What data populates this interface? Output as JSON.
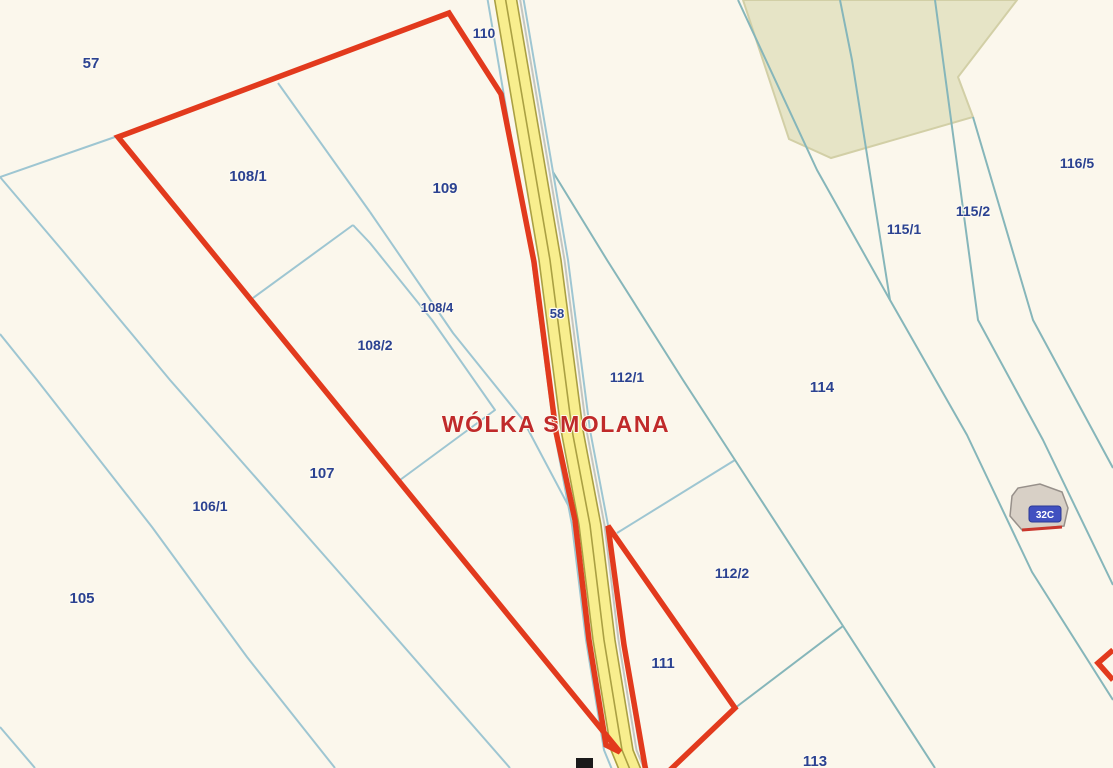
{
  "map": {
    "width": 1113,
    "height": 768,
    "background": "#fbf7ec",
    "colors": {
      "line_left": "#9ec6d2",
      "line_right": "#86b6ba",
      "selection_red": "#e23a1d",
      "label_navy": "#2b4291",
      "place_red": "#c02a2a",
      "road_yellow": "#f8ee8e",
      "road_olive": "#aaa043",
      "road_edge_blue": "#9ec6d2",
      "road_gray": "#c4c6c0",
      "green_fill": "#e6e4c6",
      "green_edge": "#d2cfa6",
      "building_fill": "#d8d0c6",
      "building_edge": "#97908a",
      "addr_bg": "#4150c0",
      "addr_text": "#ffffff",
      "marker_black": "#1a1a1a"
    },
    "place_label": {
      "text": "WÓLKA SMOLANA",
      "x": 556,
      "y": 432,
      "size": 23
    },
    "parcel_labels": [
      {
        "text": "57",
        "x": 91,
        "y": 68,
        "size": 15
      },
      {
        "text": "108/1",
        "x": 248,
        "y": 181,
        "size": 15
      },
      {
        "text": "109",
        "x": 445,
        "y": 193,
        "size": 15
      },
      {
        "text": "110",
        "x": 484,
        "y": 38,
        "size": 14
      },
      {
        "text": "108/4",
        "x": 437,
        "y": 312,
        "size": 13
      },
      {
        "text": "108/2",
        "x": 375,
        "y": 350,
        "size": 14
      },
      {
        "text": "58",
        "x": 557,
        "y": 318,
        "size": 13
      },
      {
        "text": "107",
        "x": 322,
        "y": 478,
        "size": 15
      },
      {
        "text": "106/1",
        "x": 210,
        "y": 511,
        "size": 14
      },
      {
        "text": "105",
        "x": 82,
        "y": 603,
        "size": 15
      },
      {
        "text": "112/1",
        "x": 627,
        "y": 382,
        "size": 14
      },
      {
        "text": "112/2",
        "x": 732,
        "y": 578,
        "size": 14
      },
      {
        "text": "111",
        "x": 663,
        "y": 668,
        "size": 15
      },
      {
        "text": "114",
        "x": 822,
        "y": 392,
        "size": 15
      },
      {
        "text": "115/1",
        "x": 904,
        "y": 234,
        "size": 14
      },
      {
        "text": "115/2",
        "x": 973,
        "y": 216,
        "size": 14
      },
      {
        "text": "116/5",
        "x": 1077,
        "y": 168,
        "size": 14
      },
      {
        "text": "113",
        "x": 815,
        "y": 766,
        "size": 15
      }
    ],
    "green_area": {
      "points": [
        [
          743,
          0
        ],
        [
          1017,
          0
        ],
        [
          958,
          77
        ],
        [
          973,
          117
        ],
        [
          831,
          158
        ],
        [
          789,
          139
        ]
      ]
    },
    "boundary_lines": [
      {
        "side": "left",
        "points": [
          [
            0,
            177
          ],
          [
            115,
            137
          ]
        ]
      },
      {
        "side": "left",
        "points": [
          [
            0,
            177
          ],
          [
            62,
            250
          ],
          [
            170,
            380
          ],
          [
            337,
            570
          ],
          [
            510,
            768
          ]
        ]
      },
      {
        "side": "left",
        "points": [
          [
            0,
            334
          ],
          [
            37,
            380
          ],
          [
            152,
            527
          ],
          [
            247,
            657
          ],
          [
            335,
            768
          ]
        ]
      },
      {
        "side": "left",
        "points": [
          [
            0,
            727
          ],
          [
            35,
            768
          ]
        ]
      },
      {
        "side": "left",
        "points": [
          [
            278,
            83
          ],
          [
            370,
            212
          ]
        ]
      },
      {
        "side": "left",
        "points": [
          [
            370,
            212
          ],
          [
            453,
            333
          ],
          [
            523,
            420
          ],
          [
            577,
            522
          ]
        ]
      },
      {
        "side": "left",
        "points": [
          [
            353,
            225
          ],
          [
            253,
            298
          ]
        ]
      },
      {
        "side": "left",
        "points": [
          [
            353,
            225
          ],
          [
            370,
            243
          ],
          [
            432,
            320
          ],
          [
            495,
            410
          ],
          [
            400,
            480
          ]
        ]
      },
      {
        "side": "left",
        "points": [
          [
            617,
            533
          ],
          [
            735,
            460
          ]
        ]
      },
      {
        "side": "right",
        "points": [
          [
            553,
            172
          ],
          [
            607,
            260
          ],
          [
            683,
            380
          ],
          [
            735,
            460
          ],
          [
            843,
            626
          ],
          [
            935,
            768
          ]
        ]
      },
      {
        "side": "right",
        "points": [
          [
            843,
            626
          ],
          [
            735,
            708
          ]
        ]
      },
      {
        "side": "right",
        "points": [
          [
            738,
            0
          ],
          [
            817,
            170
          ],
          [
            890,
            300
          ],
          [
            967,
            435
          ],
          [
            1032,
            572
          ],
          [
            1113,
            700
          ]
        ]
      },
      {
        "side": "right",
        "points": [
          [
            840,
            0
          ],
          [
            852,
            60
          ],
          [
            890,
            300
          ]
        ]
      },
      {
        "side": "right",
        "points": [
          [
            935,
            0
          ],
          [
            943,
            60
          ],
          [
            978,
            320
          ],
          [
            1043,
            440
          ],
          [
            1113,
            585
          ]
        ]
      },
      {
        "side": "right",
        "points": [
          [
            973,
            117
          ],
          [
            1033,
            320
          ],
          [
            1113,
            468
          ]
        ]
      }
    ],
    "road": {
      "center": [
        [
          505,
          -4
        ],
        [
          550,
          260
        ],
        [
          572,
          430
        ],
        [
          590,
          525
        ],
        [
          604,
          640
        ],
        [
          622,
          750
        ],
        [
          631,
          772
        ]
      ],
      "yellow_width": 22,
      "olive_offsets": [
        -11,
        0,
        11
      ],
      "gray_offset": 14.5,
      "blue_offsets": [
        -18,
        18
      ]
    },
    "selection_outlines": [
      {
        "name": "selection-main",
        "closed": true,
        "points": [
          [
            118,
            137
          ],
          [
            449,
            13
          ],
          [
            501,
            94
          ],
          [
            534,
            262
          ],
          [
            556,
            432
          ],
          [
            575,
            520
          ],
          [
            589,
            640
          ],
          [
            606,
            745
          ],
          [
            620,
            752
          ]
        ]
      },
      {
        "name": "selection-triangle",
        "closed": true,
        "points": [
          [
            608,
            526
          ],
          [
            735,
            708
          ],
          [
            668,
            772
          ],
          [
            646,
            772
          ],
          [
            624,
            645
          ]
        ]
      },
      {
        "name": "selection-edge-fragment",
        "closed": false,
        "points": [
          [
            1113,
            650
          ],
          [
            1098,
            663
          ],
          [
            1113,
            680
          ]
        ]
      }
    ],
    "building": {
      "outline": [
        [
          1012,
          496
        ],
        [
          1018,
          488
        ],
        [
          1040,
          484
        ],
        [
          1062,
          492
        ],
        [
          1068,
          508
        ],
        [
          1064,
          526
        ],
        [
          1022,
          530
        ],
        [
          1010,
          516
        ]
      ],
      "red_edge": [
        [
          1022,
          530
        ],
        [
          1062,
          527
        ]
      ],
      "address": {
        "text": "32C",
        "x": 1029,
        "y": 506,
        "w": 32,
        "h": 16,
        "size": 10
      }
    },
    "marker": {
      "x": 576,
      "y": 758,
      "w": 17,
      "h": 10
    }
  }
}
